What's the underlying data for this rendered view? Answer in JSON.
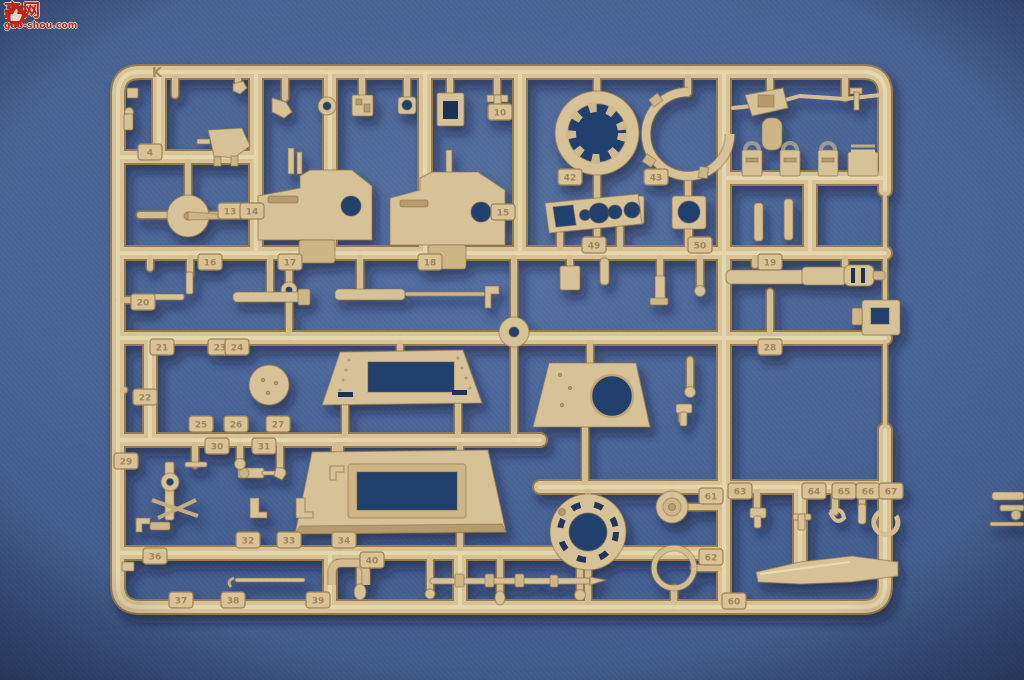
{
  "meta": {
    "description": "Photograph of a tan plastic model-kit parts sprue (runner K) lying on a blue cloth background",
    "sprue_letter": "K",
    "plastic_color": "#d7c298",
    "background_color": "#36538a"
  },
  "watermark": {
    "char_left": "高",
    "char_right": "网",
    "domain": "gao-shou.com",
    "red": "#d0261b",
    "icon": "thumb-up-gear"
  },
  "part_tabs": [
    {
      "n": "4",
      "x": 150,
      "y": 152
    },
    {
      "n": "10",
      "x": 500,
      "y": 112
    },
    {
      "n": "13",
      "x": 230,
      "y": 211
    },
    {
      "n": "14",
      "x": 252,
      "y": 211
    },
    {
      "n": "15",
      "x": 503,
      "y": 212
    },
    {
      "n": "42",
      "x": 570,
      "y": 177
    },
    {
      "n": "43",
      "x": 656,
      "y": 177
    },
    {
      "n": "49",
      "x": 594,
      "y": 245
    },
    {
      "n": "50",
      "x": 700,
      "y": 245
    },
    {
      "n": "16",
      "x": 210,
      "y": 262
    },
    {
      "n": "17",
      "x": 290,
      "y": 262
    },
    {
      "n": "18",
      "x": 430,
      "y": 262
    },
    {
      "n": "19",
      "x": 770,
      "y": 262
    },
    {
      "n": "20",
      "x": 143,
      "y": 302
    },
    {
      "n": "21",
      "x": 162,
      "y": 347
    },
    {
      "n": "23",
      "x": 220,
      "y": 347
    },
    {
      "n": "24",
      "x": 237,
      "y": 347
    },
    {
      "n": "28",
      "x": 770,
      "y": 347
    },
    {
      "n": "22",
      "x": 145,
      "y": 397
    },
    {
      "n": "25",
      "x": 201,
      "y": 424
    },
    {
      "n": "26",
      "x": 236,
      "y": 424
    },
    {
      "n": "27",
      "x": 278,
      "y": 424
    },
    {
      "n": "29",
      "x": 126,
      "y": 461
    },
    {
      "n": "30",
      "x": 217,
      "y": 446
    },
    {
      "n": "31",
      "x": 264,
      "y": 446
    },
    {
      "n": "32",
      "x": 248,
      "y": 540
    },
    {
      "n": "33",
      "x": 289,
      "y": 540
    },
    {
      "n": "34",
      "x": 344,
      "y": 540
    },
    {
      "n": "36",
      "x": 155,
      "y": 556
    },
    {
      "n": "40",
      "x": 372,
      "y": 560
    },
    {
      "n": "37",
      "x": 181,
      "y": 600
    },
    {
      "n": "38",
      "x": 233,
      "y": 600
    },
    {
      "n": "39",
      "x": 318,
      "y": 600
    },
    {
      "n": "61",
      "x": 711,
      "y": 496
    },
    {
      "n": "62",
      "x": 711,
      "y": 557
    },
    {
      "n": "63",
      "x": 740,
      "y": 491
    },
    {
      "n": "64",
      "x": 814,
      "y": 491
    },
    {
      "n": "65",
      "x": 844,
      "y": 491
    },
    {
      "n": "66",
      "x": 868,
      "y": 491
    },
    {
      "n": "67",
      "x": 891,
      "y": 491
    },
    {
      "n": "60",
      "x": 734,
      "y": 601
    }
  ]
}
